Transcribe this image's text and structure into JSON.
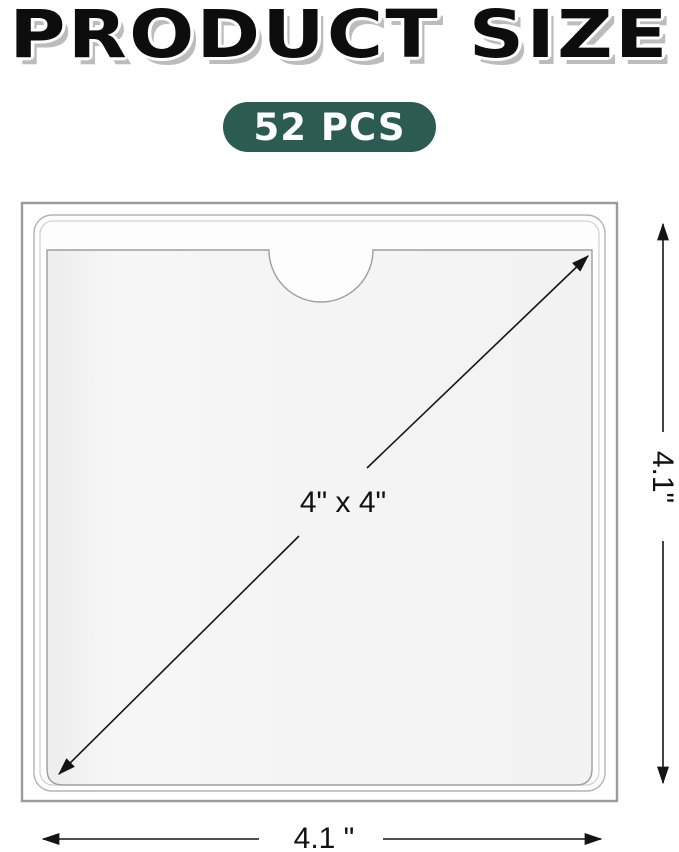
{
  "title": "PRODUCT SIZE",
  "badge": {
    "label": "52 PCS"
  },
  "diagram": {
    "description": "square self-adhesive clear pocket sleeve with semicircular thumb-notch opening at top",
    "labels": {
      "diagonal": "4\" x 4\"",
      "height": "4.1\"",
      "width": "4.1 \""
    }
  },
  "colors": {
    "badge_bg": "#2b5b51",
    "badge_text": "#ffffff",
    "title_color": "#0d0d0d",
    "title_shadow": "#bcbcbc",
    "dimension_line": "#161616",
    "backing_frame": "#9a9a9a",
    "pocket_outline": "#9e9e9e",
    "pocket_fill": "#f4f4f4"
  }
}
